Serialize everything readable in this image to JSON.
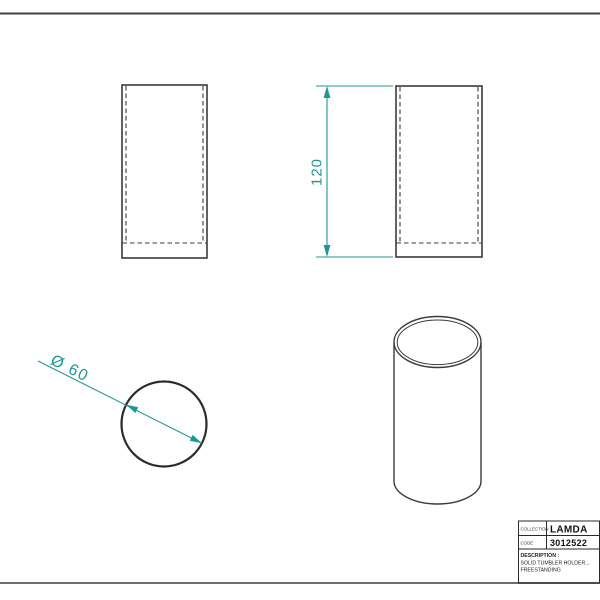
{
  "colors": {
    "line": "#3b3b3b",
    "dimension": "#1d9795",
    "frame_top": "#3f3f3f",
    "frame_bottom": "#6e6e6e",
    "title_block_border": "#2a2a2a",
    "background": "#ffffff"
  },
  "dimensions": {
    "height": "120",
    "diameter": "Ø 60"
  },
  "title_block": {
    "collection_label": "COLLECTION",
    "collection_value": "LAMDA",
    "code_label": "CODE",
    "code_value": "3012522",
    "description_label": "DESCRIPTION :",
    "description_lines": [
      "SOLID TUMBLER HOLDER...",
      "FREESTANDING"
    ]
  }
}
